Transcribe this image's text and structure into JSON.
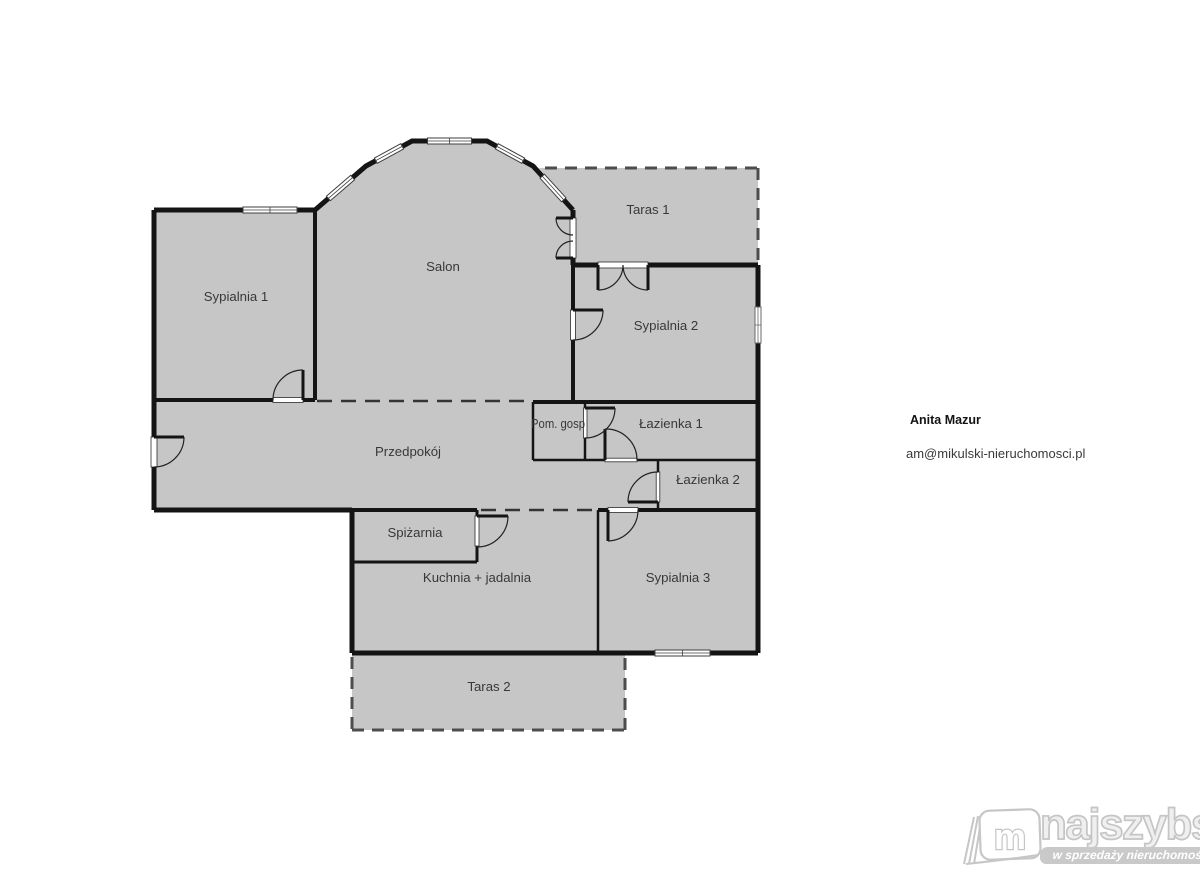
{
  "page": {
    "background_color": "#ffffff"
  },
  "floorplan": {
    "room_fill_color": "#c6c6c6",
    "wall_color": "#141414",
    "terrace_dash_color": "#4d4d4d",
    "open_boundary_dash_color": "#343434",
    "rooms": [
      {
        "id": "sypialnia-1",
        "label": "Sypialnia 1"
      },
      {
        "id": "salon",
        "label": "Salon"
      },
      {
        "id": "taras-1",
        "label": "Taras 1"
      },
      {
        "id": "sypialnia-2",
        "label": "Sypialnia 2"
      },
      {
        "id": "pom-gosp",
        "label": "Pom. gosp"
      },
      {
        "id": "lazienka-1",
        "label": "Łazienka 1"
      },
      {
        "id": "przedpokoj",
        "label": "Przedpokój"
      },
      {
        "id": "lazienka-2",
        "label": "Łazienka 2"
      },
      {
        "id": "spizarnia",
        "label": "Spiżarnia"
      },
      {
        "id": "kuchnia-jadalnia",
        "label": "Kuchnia + jadalnia"
      },
      {
        "id": "sypialnia-3",
        "label": "Sypialnia 3"
      },
      {
        "id": "taras-2",
        "label": "Taras 2"
      }
    ]
  },
  "agent": {
    "name": "Anita Mazur",
    "email": "am@mikulski-nieruchomosci.pl"
  },
  "logo": {
    "monogram": "m",
    "brand": "najszybsi",
    "tagline": "w sprzedaży nieruchomości"
  }
}
